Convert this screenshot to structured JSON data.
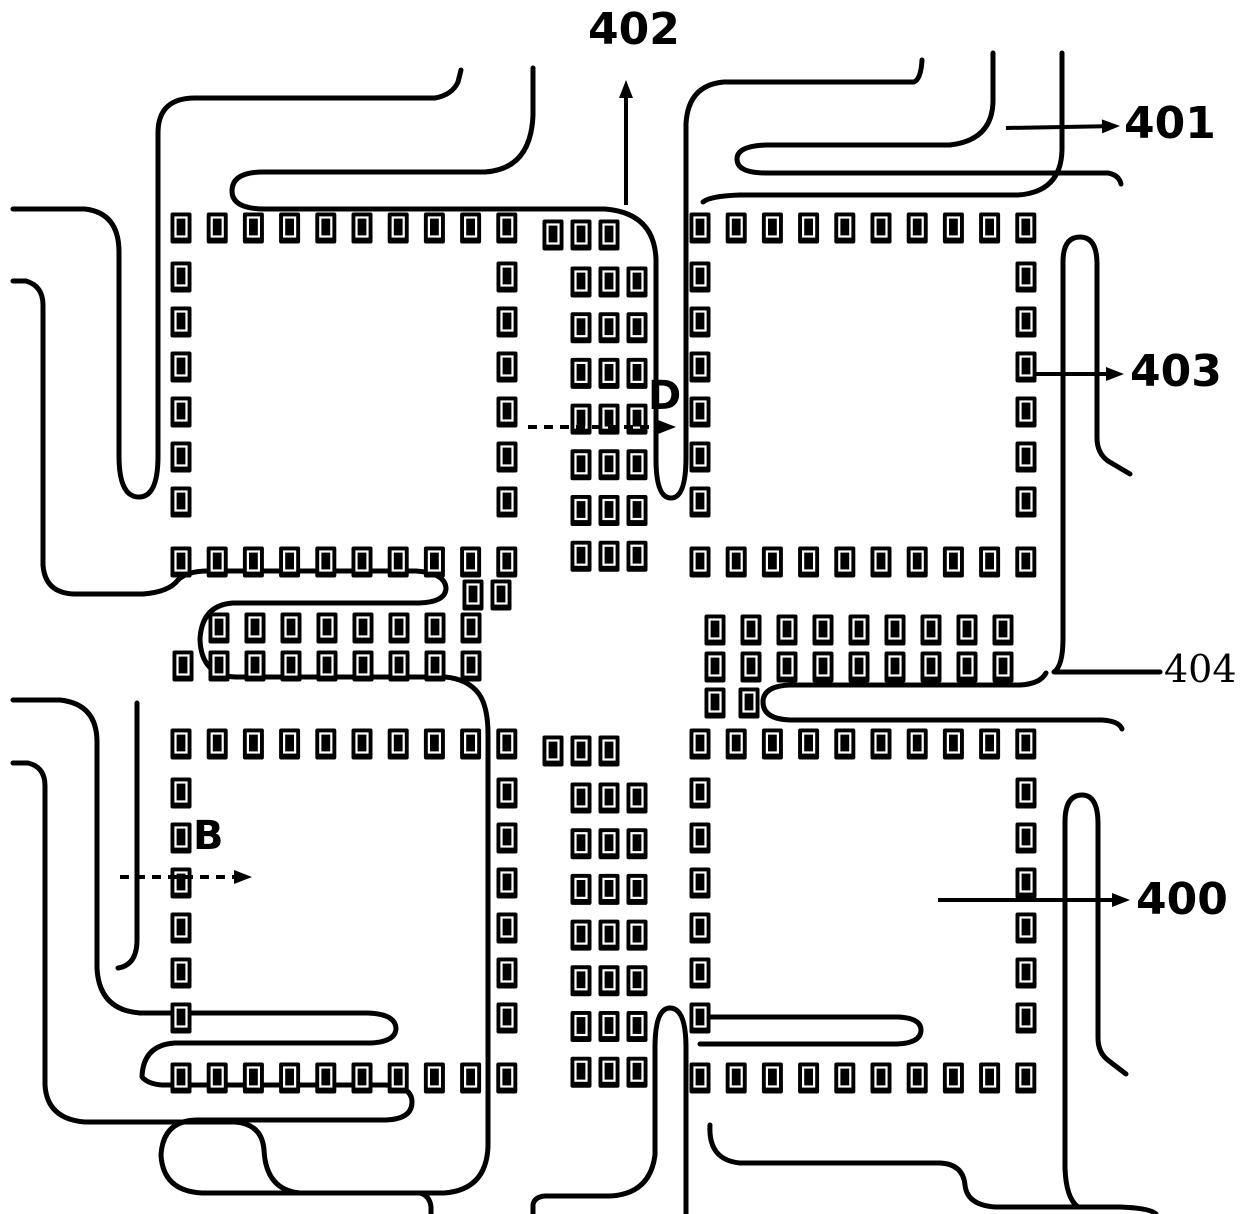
{
  "figure": {
    "description": "Patent wiring diagram: four square land-pad rings (400) with serpentine fan-out wiring lines (401), vertical lead-out direction (402), pad (403), connecting row pads (404), and section indicators B and D",
    "canvas": {
      "w": 1240,
      "h": 1214
    },
    "colors": {
      "ink": "#000000",
      "paper": "#ffffff"
    },
    "labels": {
      "l402": {
        "text": "402",
        "x": 588,
        "y": 8,
        "size": 44,
        "font": "sans"
      },
      "l401": {
        "text": "401",
        "x": 1124,
        "y": 102,
        "size": 44,
        "font": "sans"
      },
      "l403": {
        "text": "403",
        "x": 1130,
        "y": 350,
        "size": 44,
        "font": "sans"
      },
      "l404": {
        "text": "404",
        "x": 1164,
        "y": 650,
        "size": 38,
        "font": "serif"
      },
      "l400": {
        "text": "400",
        "x": 1136,
        "y": 878,
        "size": 44,
        "font": "sans"
      },
      "lD": {
        "text": "D",
        "x": 648,
        "y": 376,
        "size": 40,
        "font": "sans"
      },
      "lB": {
        "text": "B",
        "x": 193,
        "y": 816,
        "size": 40,
        "font": "sans"
      }
    },
    "arrows": [
      {
        "name": "arrow-402",
        "style": "solid",
        "x1": 626,
        "y1": 205,
        "x2": 626,
        "y2": 80
      },
      {
        "name": "arrow-401",
        "style": "solid",
        "x1": 1006,
        "y1": 128,
        "x2": 1120,
        "y2": 126
      },
      {
        "name": "arrow-403",
        "style": "solid",
        "x1": 1036,
        "y1": 374,
        "x2": 1124,
        "y2": 374
      },
      {
        "name": "arrow-400",
        "style": "solid",
        "x1": 938,
        "y1": 900,
        "x2": 1130,
        "y2": 900
      },
      {
        "name": "arrow-D",
        "style": "dashed",
        "x1": 528,
        "y1": 427,
        "x2": 676,
        "y2": 427
      },
      {
        "name": "arrow-B",
        "style": "dashed",
        "x1": 120,
        "y1": 877,
        "x2": 252,
        "y2": 877
      }
    ],
    "traces": [
      "M 13,209 H 85 Q 119,213 119,252 V 456 Q 119,497 139,497 Q 158,497 158,456 V 133 Q 158,98 195,98 H 435 Q 452,95 458,82 L 461,70",
      "M 533,68 V 115 Q 531,169 485,172 H 263 Q 232,172 232,191 Q 232,209 265,209 H 605 Q 654,213 656,259 V 459 Q 656,498 671,498 Q 686,498 686,457 V 124 Q 688,85 724,82 H 914 Q 921,79 922,60",
      "M 13,281 H 26 Q 43,286 43,305 V 565 Q 45,593 74,594 H 143 Q 169,592 178,580 Q 187,571 208,571 H 416 Q 445,573 446,588 Q 446,602 419,603 H 233 Q 202,605 200,639 Q 201,676 236,677 H 445 Q 468,679 479,694 Q 488,707 488,734 V 1147 Q 486,1190 444,1193 H 202 Q 163,1191 161,1155 Q 163,1121 196,1120 H 386 Q 412,1119 412,1102 Q 412,1086 385,1085 H 162 Q 148,1084 142,1077 Q 143,1045 175,1043 H 370 Q 396,1042 396,1028 Q 395,1014 368,1013 H 140 Q 99,1010 97,968 V 742 Q 97,704 60,700 L 13,700",
      "M 137,703 V 940 Q 137,965 118,968",
      "M 993,53 V 100 Q 993,140 950,145 H 766 Q 737,146 737,159 Q 737,173 766,173 H 1108 Q 1119,175 1121,184",
      "M 1062,53 V 150 Q 1061,192 1018,195 H 740 Q 710,196 703,202",
      "M 1160,672 H 1054 Q 1063,666 1063,638 V 262 Q 1063,237 1080,237 Q 1097,237 1097,264 V 438 Q 1097,453 1108,461 L 1130,474",
      "M 1046,673 Q 1040,684 1020,685 H 790 Q 763,686 763,702 Q 763,719 790,720 H 1102 Q 1119,721 1122,729",
      "M 13,763 H 28 Q 45,767 45,786 V 1085 Q 47,1119 85,1122 H 235 Q 262,1124 264,1150 Q 266,1190 300,1193 H 420 Q 430,1196 431,1207 L 431,1214",
      "M 533,1214 V 1205 Q 534,1197 545,1196 H 610 Q 650,1194 655,1155 V 1048 Q 655,1008 670,1008 Q 686,1008 686,1048 V 1214",
      "M 700,1017 H 898 Q 921,1018 921,1030 Q 921,1043 897,1044 H 700",
      "M 710,1125 Q 708,1160 740,1163 H 940 Q 963,1164 965,1185 Q 967,1205 995,1207 H 1120 Q 1150,1208 1156,1214",
      "M 1078,1207 Q 1066,1198 1065,1168 V 822 Q 1065,795 1082,795 Q 1098,795 1098,824 V 1038 Q 1098,1053 1109,1061 L 1126,1074"
    ],
    "pad_style": {
      "w": 21,
      "h": 31,
      "inner_w": 11,
      "inner_h": 19,
      "inner_dy": 5,
      "inner_stroke": 2.2
    },
    "pad_runs": [
      {
        "axis": "h",
        "x": 181,
        "y": 228,
        "pitch": 36.2,
        "count": 10
      },
      {
        "axis": "h",
        "x": 181,
        "y": 562,
        "pitch": 36.2,
        "count": 10
      },
      {
        "axis": "v",
        "x": 181,
        "y": 277,
        "pitch": 45,
        "count": 6
      },
      {
        "axis": "v",
        "x": 507,
        "y": 277,
        "pitch": 45,
        "count": 6
      },
      {
        "axis": "h",
        "x": 700,
        "y": 228,
        "pitch": 36.2,
        "count": 10
      },
      {
        "axis": "h",
        "x": 700,
        "y": 562,
        "pitch": 36.2,
        "count": 10
      },
      {
        "axis": "v",
        "x": 700,
        "y": 277,
        "pitch": 45,
        "count": 6
      },
      {
        "axis": "v",
        "x": 1026,
        "y": 277,
        "pitch": 45,
        "count": 6
      },
      {
        "axis": "h",
        "x": 181,
        "y": 744,
        "pitch": 36.2,
        "count": 10
      },
      {
        "axis": "h",
        "x": 181,
        "y": 1078,
        "pitch": 36.2,
        "count": 10
      },
      {
        "axis": "v",
        "x": 181,
        "y": 793,
        "pitch": 45,
        "count": 6
      },
      {
        "axis": "v",
        "x": 507,
        "y": 793,
        "pitch": 45,
        "count": 6
      },
      {
        "axis": "h",
        "x": 700,
        "y": 744,
        "pitch": 36.2,
        "count": 10
      },
      {
        "axis": "h",
        "x": 700,
        "y": 1078,
        "pitch": 36.2,
        "count": 10
      },
      {
        "axis": "v",
        "x": 700,
        "y": 793,
        "pitch": 45,
        "count": 6
      },
      {
        "axis": "v",
        "x": 1026,
        "y": 793,
        "pitch": 45,
        "count": 6
      },
      {
        "axis": "v",
        "x": 581,
        "y": 282,
        "pitch": 45.7,
        "count": 7
      },
      {
        "axis": "v",
        "x": 609,
        "y": 282,
        "pitch": 45.7,
        "count": 7
      },
      {
        "axis": "v",
        "x": 637,
        "y": 282,
        "pitch": 45.7,
        "count": 7
      },
      {
        "axis": "v",
        "x": 581,
        "y": 798,
        "pitch": 45.7,
        "count": 7
      },
      {
        "axis": "v",
        "x": 609,
        "y": 798,
        "pitch": 45.7,
        "count": 7
      },
      {
        "axis": "v",
        "x": 637,
        "y": 798,
        "pitch": 45.7,
        "count": 7
      },
      {
        "axis": "h",
        "x": 219,
        "y": 628,
        "pitch": 36,
        "count": 8
      },
      {
        "axis": "h",
        "x": 183,
        "y": 666,
        "pitch": 36,
        "count": 9
      },
      {
        "axis": "h",
        "x": 715,
        "y": 630,
        "pitch": 36,
        "count": 9
      },
      {
        "axis": "h",
        "x": 715,
        "y": 667,
        "pitch": 36,
        "count": 9
      }
    ],
    "pad_singles": [
      [
        553,
        235
      ],
      [
        581,
        235
      ],
      [
        609,
        235
      ],
      [
        553,
        751
      ],
      [
        581,
        751
      ],
      [
        609,
        751
      ],
      [
        473,
        595
      ],
      [
        501,
        595
      ],
      [
        715,
        703
      ],
      [
        749,
        703
      ]
    ]
  }
}
